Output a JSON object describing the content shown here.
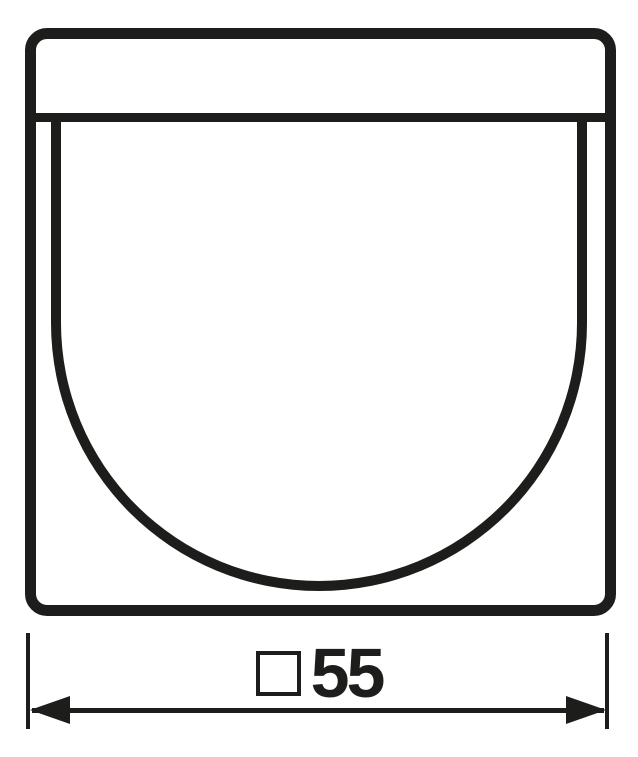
{
  "figure": {
    "type": "technical-dimension-drawing",
    "dimension_label": {
      "symbol": "□",
      "value": "55",
      "text": "□55"
    }
  },
  "icons": {
    "square_symbol": "square-outline-symbol",
    "left_arrowhead": "filled-triangle-pointing-left",
    "right_arrowhead": "filled-triangle-pointing-right"
  },
  "colors": {
    "line": "#1d1d1b",
    "background": "#ffffff"
  }
}
